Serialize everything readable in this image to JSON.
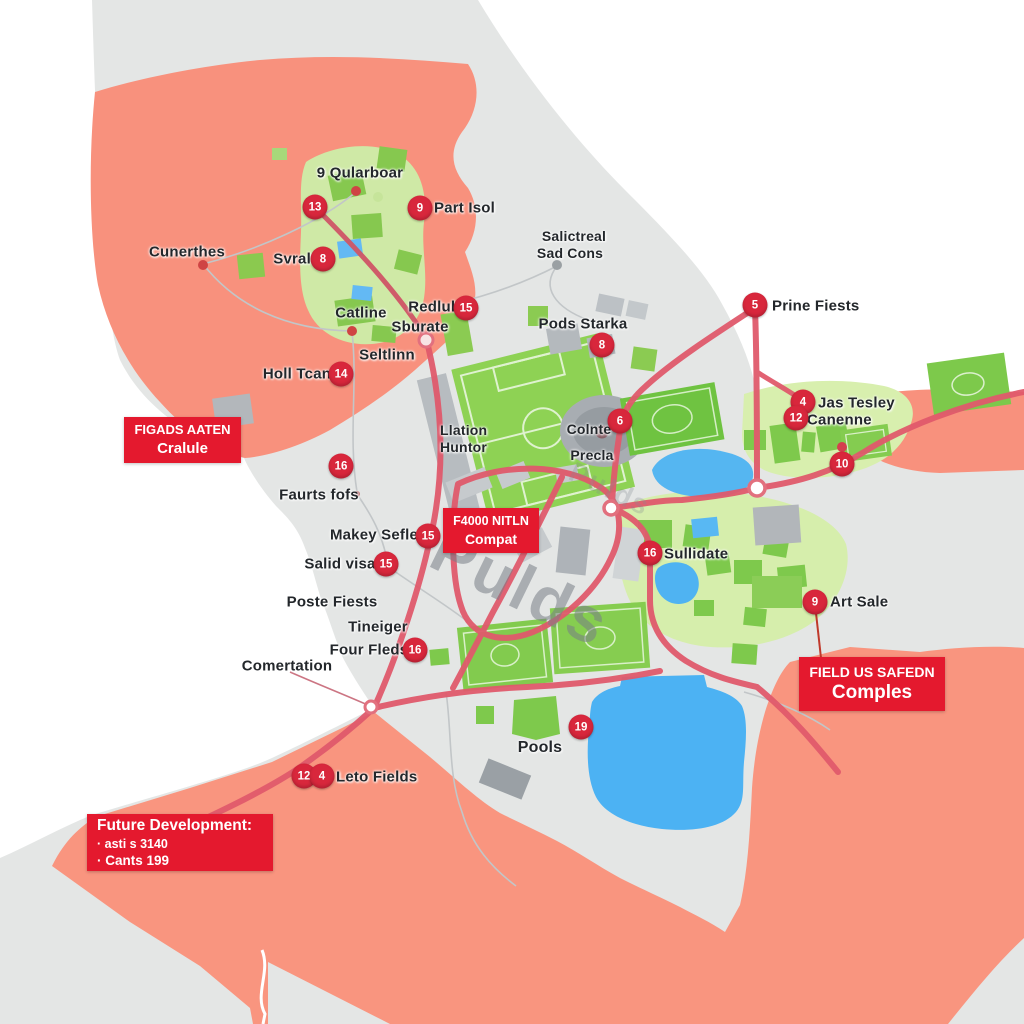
{
  "map": {
    "watermark": "Pulds",
    "watermark_faint": "Pulds"
  },
  "palette": {
    "ink": "#23272b",
    "marker": "#d8273c",
    "box": "#e4192e",
    "land": "#e4e6e5",
    "zone": "#f8917d",
    "park": "#cfe9a6",
    "field": "#82cb4e",
    "water": "#4fb3f2",
    "road": "#e05a6c"
  },
  "labels": {
    "qularboar": "9 Qularboar",
    "part_isol": "Part Isol",
    "cunerthes": "Cunerthes",
    "svralter": "Svralter",
    "salictreal_1": "Salictreal",
    "salictreal_2": "Sad Cons",
    "catline": "Catline",
    "redluls": "Redluls",
    "sburate": "Sburate",
    "seltlinn": "Seltlinn",
    "pods_starka": "Pods Starka",
    "prine_fiests": "Prine Fiests",
    "holl_tcan": "Holl Tcan",
    "llation_1": "Llation",
    "llation_2": "Huntor",
    "colnte": "Colnte",
    "precla": "Precla",
    "faurts_fofs": "Faurts fofs",
    "makey_sefler": "Makey Sefler",
    "salid_visa": "Salid visa",
    "poste_fiests": "Poste Fiests",
    "tineiger": "Tineiger",
    "four_fleds": "Four Fleds",
    "comertation": "Comertation",
    "jas_tesley": "Jas Tesley",
    "canenne": "Canenne",
    "sullidate": "Sullidate",
    "art_sale": "Art Sale",
    "pools": "Pools",
    "leto_fields": "Leto Fields"
  },
  "markers": [
    "13",
    "9",
    "8",
    "15",
    "8",
    "5",
    "14",
    "16",
    "6",
    "4",
    "12",
    "10",
    "15",
    "15",
    "16",
    "16",
    "9",
    "19",
    "12",
    "4"
  ],
  "boxes": {
    "figads": {
      "line1": "FIGADS AATEN",
      "line2": "Cralule"
    },
    "f4000": {
      "line1": "F4000 NITLN",
      "line2": "Compat"
    },
    "field": {
      "line1": "FIELD US SAFEDN",
      "line2": "Comples"
    },
    "future": {
      "line1": "Future Development:",
      "line2": "· asti s 3140",
      "line3": "· Cants 199"
    }
  }
}
